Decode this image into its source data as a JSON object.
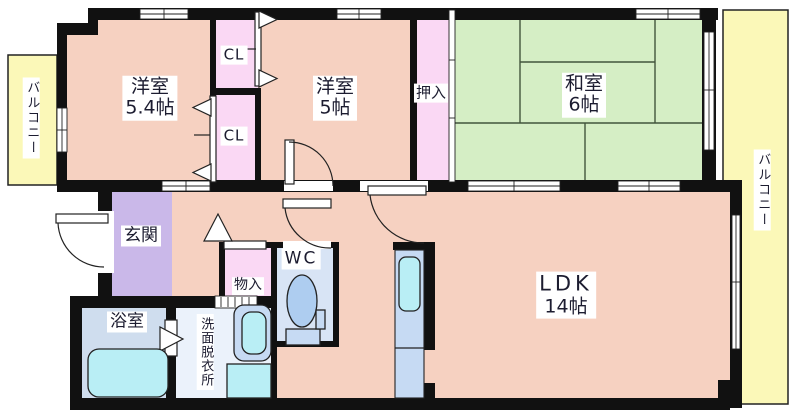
{
  "floorplan": {
    "rooms": {
      "balcony_left": "バルコニー",
      "bedroom1_name": "洋室",
      "bedroom1_size": "5.4帖",
      "closet_top": "CL",
      "closet_bottom": "CL",
      "bedroom2_name": "洋室",
      "bedroom2_size": "5帖",
      "oshiire": "押入",
      "washitsu_name": "和室",
      "washitsu_size": "6帖",
      "balcony_right": "バルコニー",
      "genkan": "玄関",
      "storage": "物入",
      "wc": "WC",
      "bath": "浴室",
      "washroom": "洗面脱衣所",
      "ldk_name": "LDK",
      "ldk_size": "14帖"
    },
    "colors": {
      "wall": "#111111",
      "room-pink": "#f6d1c1",
      "closet-pink": "#fad8f4",
      "tatami-green": "#d5eec5",
      "balcony-yellow": "#fbf8b8",
      "entry-purple": "#cab8e9",
      "bath-floor": "#cfddee",
      "wc-floor": "#d8e4f5",
      "washroom-floor": "#ebf2fb",
      "fixture-blue": "#c6daf3",
      "water-cyan": "#b9eef5",
      "toilet-blue": "#aecdf0",
      "line-dark": "#222222",
      "tatami-line": "#42553c"
    }
  }
}
